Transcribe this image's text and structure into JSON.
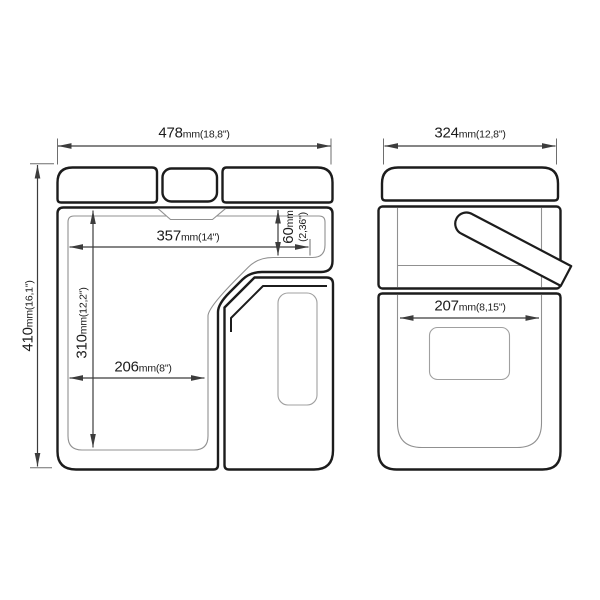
{
  "drawing": {
    "dimensions": {
      "front_total_width": {
        "value": "478",
        "suffix": "mm(18,8\")"
      },
      "front_total_height": {
        "value": "410",
        "suffix": "mm(16,1\")"
      },
      "front_inner_width": {
        "value": "357",
        "suffix": "mm(14\")"
      },
      "front_step_height": {
        "value": "60",
        "suffix": "mm",
        "detail": "(2,36\")"
      },
      "front_inner_height": {
        "value": "310",
        "suffix": "mm(12,2\")"
      },
      "front_lower_inner_width": {
        "value": "206",
        "suffix": "mm(8\")"
      },
      "side_total_width": {
        "value": "324",
        "suffix": "mm(12,8\")"
      },
      "side_inner_width": {
        "value": "207",
        "suffix": "mm(8,15\")"
      }
    },
    "colors": {
      "background": "#ffffff",
      "outline": "#1c1c1c",
      "thin_line": "#909090",
      "dimension_line": "#3c3c3c",
      "text": "#1c1c1c"
    }
  }
}
